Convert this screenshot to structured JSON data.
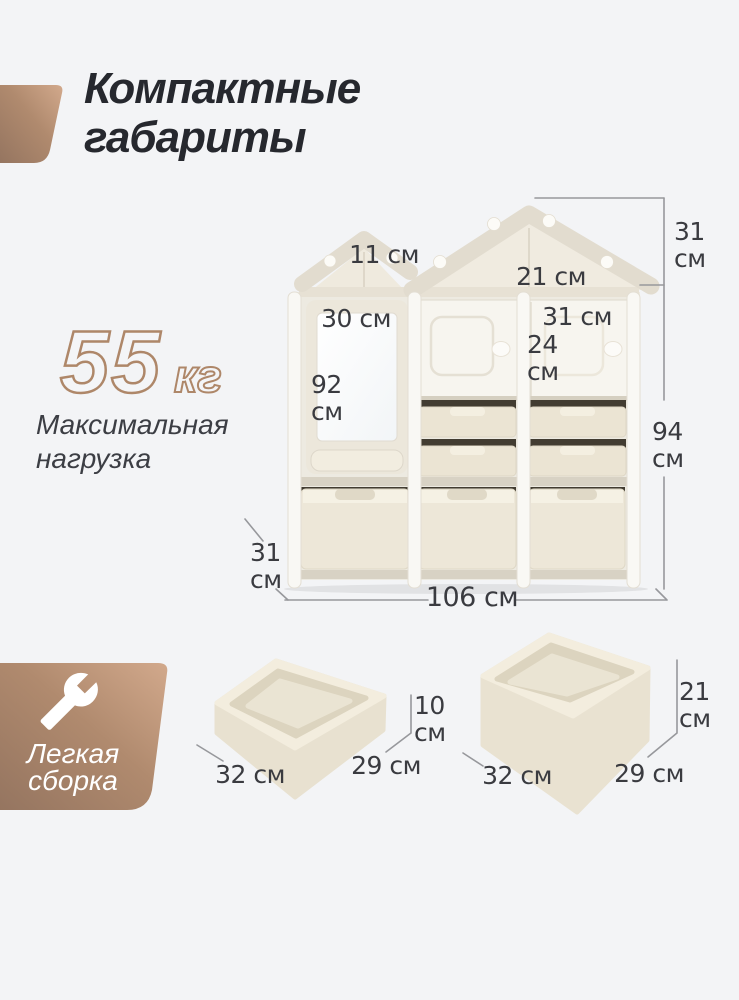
{
  "header": {
    "title_lines": [
      "Компактные",
      "габариты"
    ]
  },
  "max_load": {
    "value": "55",
    "unit": "кг",
    "caption_lines": [
      "Максимальная",
      "нагрузка"
    ]
  },
  "assembly_badge": {
    "icon": "wrench-icon",
    "label_lines": [
      "Легкая",
      "сборка"
    ]
  },
  "dimensions": {
    "small_roof_width": "11 см",
    "large_roof_width": "21 см",
    "roof_height": [
      "31",
      "см"
    ],
    "whiteboard_width": "30 см",
    "right_door_width": "31 см",
    "right_door_height": [
      "24",
      "см"
    ],
    "whiteboard_height": [
      "92",
      "см"
    ],
    "body_height": [
      "94",
      "см"
    ],
    "unit_depth": [
      "31",
      "см"
    ],
    "unit_width": "106 см"
  },
  "small_tray": {
    "width": "32 см",
    "depth": "29 см",
    "height": [
      "10",
      "см"
    ]
  },
  "large_bin": {
    "width": "32 см",
    "depth": "29 см",
    "height": [
      "21",
      "см"
    ]
  },
  "colors": {
    "background": "#f3f4f6",
    "accent_dark": "#957560",
    "accent_light": "#d2a98c",
    "outlined_text": "#ae8769",
    "dimension_line": "#97989c"
  }
}
